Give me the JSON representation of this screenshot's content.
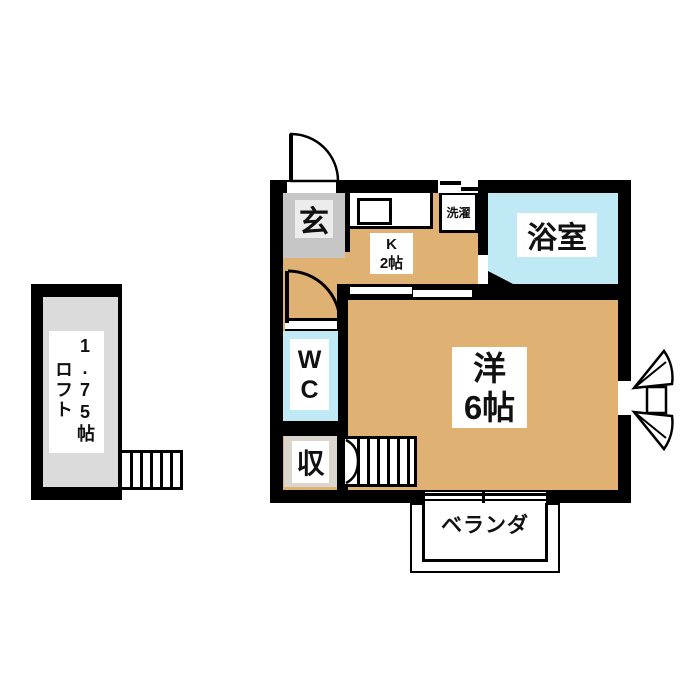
{
  "title": "apartment floor plan",
  "colors": {
    "wall": "#000000",
    "floor_tan": "#dfb173",
    "water_blue": "#bfe9f5",
    "genkan_gray": "#c6c6c6",
    "genkan_inner_gray": "#ececec",
    "storage_beige": "#dbd6cd",
    "loft_gray": "#dbdbdb",
    "background": "#ffffff"
  },
  "rooms": {
    "genkan": {
      "label": "玄"
    },
    "kitchen": {
      "name": "K",
      "size": "2帖"
    },
    "laundry": {
      "label": "洗濯"
    },
    "bathroom": {
      "label": "浴室"
    },
    "wc": {
      "line1": "W",
      "line2": "C"
    },
    "storage": {
      "label": "収"
    },
    "western_room": {
      "name": "洋",
      "size": "6帖"
    },
    "veranda": {
      "label": "ベランダ"
    },
    "loft": {
      "name": "ロフト",
      "size": "1.75帖"
    }
  }
}
